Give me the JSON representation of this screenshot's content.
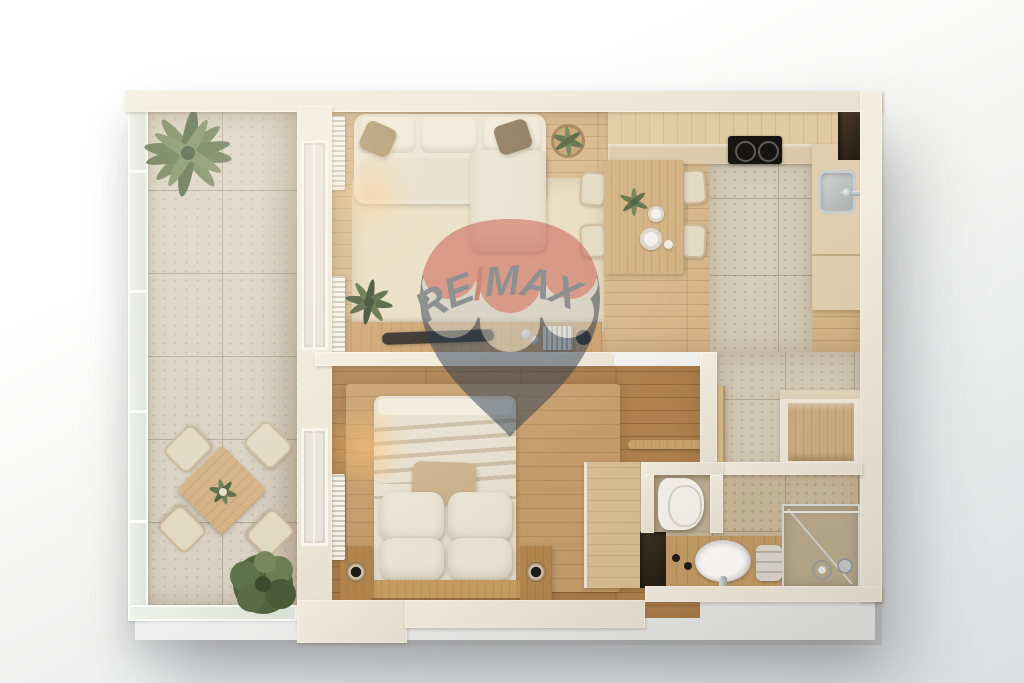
{
  "watermark": {
    "brand": "RE/MAX",
    "re": "RE",
    "slash": "/",
    "max": "MAX",
    "balloon_red": "#c8564a",
    "balloon_band": "#f3efe4",
    "balloon_navy": "#2b3c52",
    "text_color": "#31455f",
    "slash_color": "#ab332e",
    "opacity": "0.5"
  },
  "scene": {
    "type": "apartment-floor-plan-3d-top-view",
    "rooms": [
      {
        "name": "balcony"
      },
      {
        "name": "living-room"
      },
      {
        "name": "kitchen-dining"
      },
      {
        "name": "bedroom"
      },
      {
        "name": "hallway"
      },
      {
        "name": "bathroom"
      }
    ],
    "palette": {
      "background_top": "#ffffff",
      "background_bottom": "#dcdfe0",
      "walls": "#ece5d7",
      "wood_light": "#d6b588",
      "wood_dark": "#b1824e",
      "tile_balcony": "#d9d2c3",
      "tile_kitchen": "#d4ccb8",
      "tile_bathroom": "#c9b99b",
      "rug": "#e7dcc1",
      "sofa": "#eae2d0",
      "plant_green": "#5c6e47",
      "cooktop_black": "#161412",
      "chrome": "#b9c0c4"
    }
  }
}
